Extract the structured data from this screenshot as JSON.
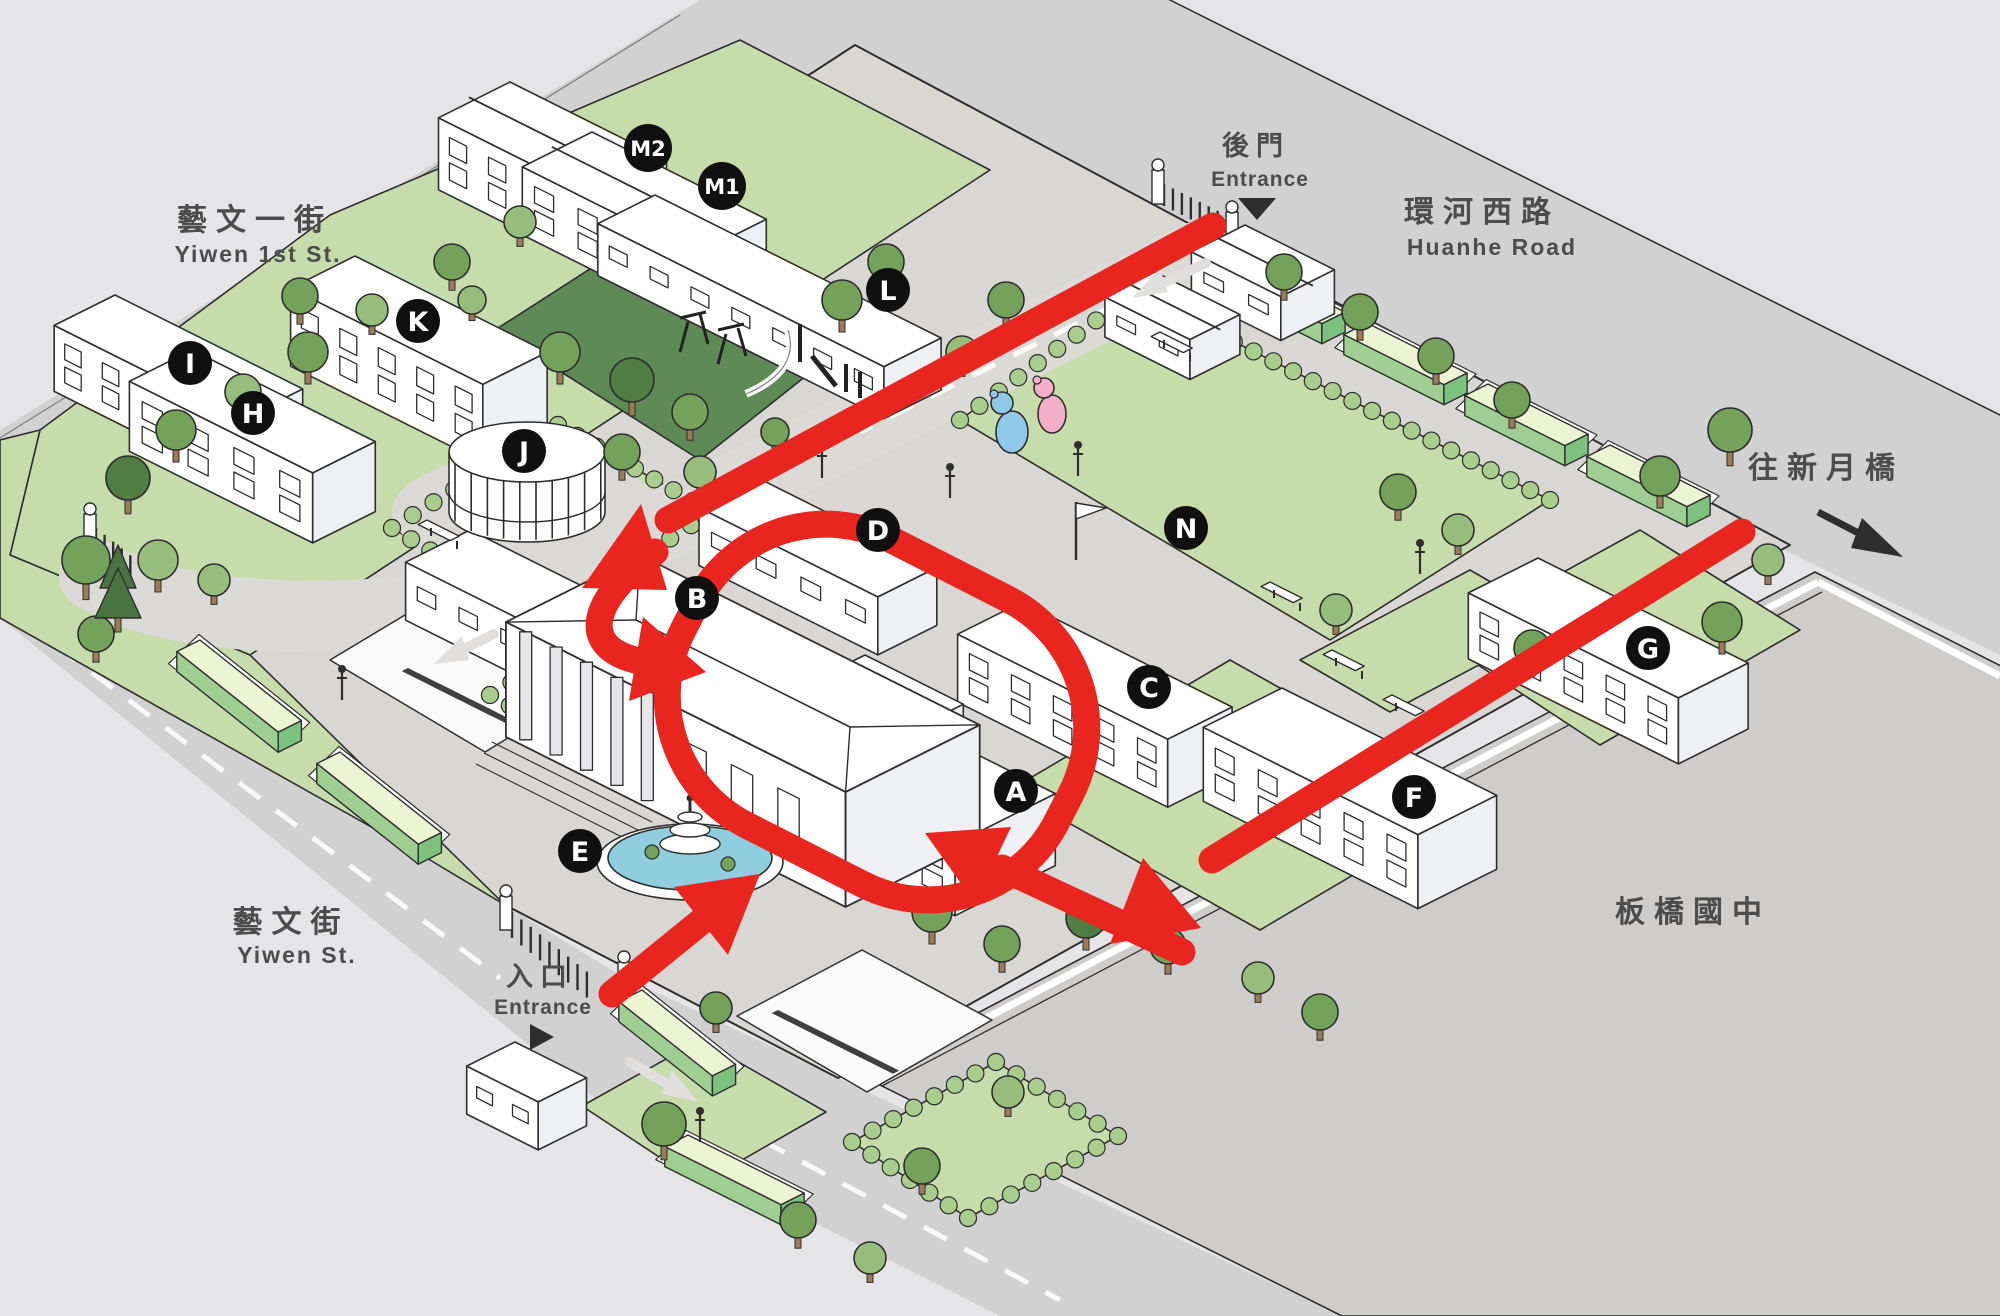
{
  "streets": {
    "yiwen1st": {
      "zh": "藝文一街",
      "en": "Yiwen 1st St."
    },
    "yiwen": {
      "zh": "藝文街",
      "en": "Yiwen St."
    },
    "huanhe": {
      "zh": "環河西路",
      "en": "Huanhe Road"
    },
    "bridge": {
      "zh": "往新月橋"
    },
    "school": {
      "zh": "板橋國中"
    }
  },
  "entrances": {
    "back": {
      "zh": "後門",
      "en": "Entrance"
    },
    "main": {
      "zh": "入口",
      "en": "Entrance"
    }
  },
  "buildings": [
    {
      "label": "A"
    },
    {
      "label": "B"
    },
    {
      "label": "C"
    },
    {
      "label": "D"
    },
    {
      "label": "E"
    },
    {
      "label": "F"
    },
    {
      "label": "G"
    },
    {
      "label": "H"
    },
    {
      "label": "I"
    },
    {
      "label": "J"
    },
    {
      "label": "K"
    },
    {
      "label": "L"
    },
    {
      "label": "M1"
    },
    {
      "label": "M2"
    },
    {
      "label": "N"
    }
  ],
  "colors": {
    "bg": "#e5e5e7",
    "road": "#d2d1d2",
    "campus": "#d9d7d4",
    "school-ground": "#cfcdcb",
    "lawn": "#c6dcab",
    "lawn-dark": "#5e8a55",
    "hedge-top": "#edf4d4",
    "hedge-front": "#9fce93",
    "hedge-end": "#7cc17e",
    "bump": "#a9cd8d",
    "tree-mid": "#74a25a",
    "tree-dark": "#4f7d42",
    "tree-light": "#97bd7c",
    "trunk": "#9b7b58",
    "building": "#ffffff",
    "shade": "#eef0f3",
    "outline": "#2e2e2e",
    "route": "#e8251f",
    "badge": "#101010",
    "water": "#8ecede",
    "label": "#4c4c4c"
  }
}
